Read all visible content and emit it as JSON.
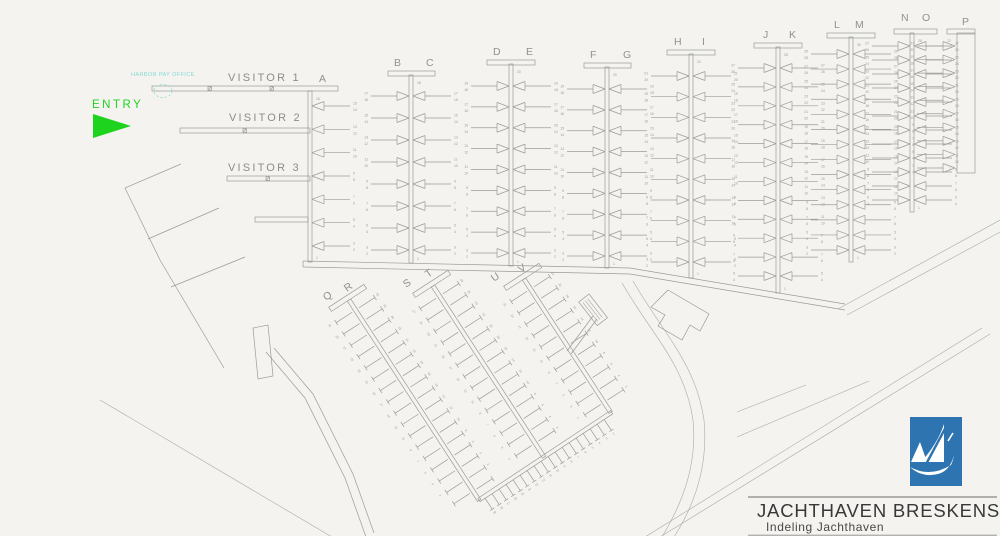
{
  "map": {
    "entry_label": "ENTRY",
    "annotation_teal": "HARBOR PAY OFFICE",
    "visitor_piers": [
      {
        "label": "VISITOR 1"
      },
      {
        "label": "VISITOR 2"
      },
      {
        "label": "VISITOR 3"
      }
    ],
    "piers": [
      {
        "id": "A",
        "labels": [
          "A"
        ],
        "berths": 16
      },
      {
        "id": "BC",
        "labels": [
          "B",
          "C"
        ],
        "berths": 18
      },
      {
        "id": "DE",
        "labels": [
          "D",
          "E"
        ],
        "berths": 20
      },
      {
        "id": "FG",
        "labels": [
          "F",
          "G"
        ],
        "berths": 20
      },
      {
        "id": "HI",
        "labels": [
          "H",
          "I"
        ],
        "berths": 22
      },
      {
        "id": "JK",
        "labels": [
          "J",
          "K"
        ],
        "berths": 28
      },
      {
        "id": "LM",
        "labels": [
          "L",
          "M"
        ],
        "berths": 30
      },
      {
        "id": "NO",
        "labels": [
          "N",
          "O"
        ],
        "berths": 28
      },
      {
        "id": "P",
        "labels": [
          "P"
        ],
        "berths": 22
      },
      {
        "id": "QR",
        "labels": [
          "Q",
          "R"
        ],
        "berths": 32
      },
      {
        "id": "ST",
        "labels": [
          "S",
          "T"
        ],
        "berths": 28
      },
      {
        "id": "UV",
        "labels": [
          "U",
          "V"
        ],
        "berths": 22
      }
    ],
    "colors": {
      "background": "#f4f3ef",
      "line_gray": "#9b9b9b",
      "entry_green": "#22d122",
      "annotation_teal": "#86d9d3",
      "logo_blue": "#2e74b0"
    }
  },
  "title_block": {
    "title": "JACHTHAVEN BRESKENS",
    "subtitle": "Indeling Jachthaven",
    "logo_icon": "sailboat"
  }
}
